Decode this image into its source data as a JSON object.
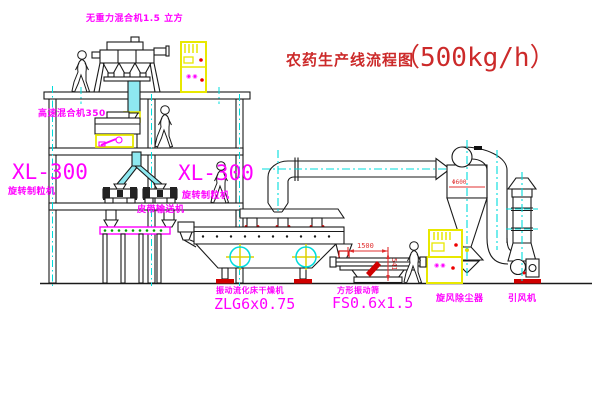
{
  "title": {
    "name": "农药生产线流程图",
    "capacity": "（500kg/h）"
  },
  "equipment_labels": {
    "gravity_mixer": "无重力混合机1.5 立方",
    "high_speed_mixer": "高速混合机350",
    "granulator_left": {
      "model": "XL-300",
      "name": "旋转制粒机"
    },
    "granulator_right": {
      "model": "XL-300",
      "name": "旋转制粒机"
    },
    "belt_conveyor": "皮带输送机",
    "fluid_bed_dryer": {
      "name": "振动流化床干燥机",
      "model": "ZLG6x0.75"
    },
    "vibrating_screen": {
      "name": "方形振动筛",
      "model": "FS0.6x1.5"
    },
    "cyclone": "旋风除尘器",
    "induced_draft_fan": "引风机"
  },
  "dimensions": {
    "screen_length": "1500",
    "screen_height": "541",
    "cyclone_dia": "Φ600"
  },
  "cabinet_markings": {
    "cabinet1": "◉◉",
    "cabinet2": "◉◉"
  },
  "colors": {
    "line": "#1a1a1a",
    "centerline": "#00dcdc",
    "label": "#ff00ff",
    "title": "#cc2a2a",
    "highlight": "#e8e800",
    "dimension": "#e03030",
    "status_dot": "#ee0000"
  }
}
